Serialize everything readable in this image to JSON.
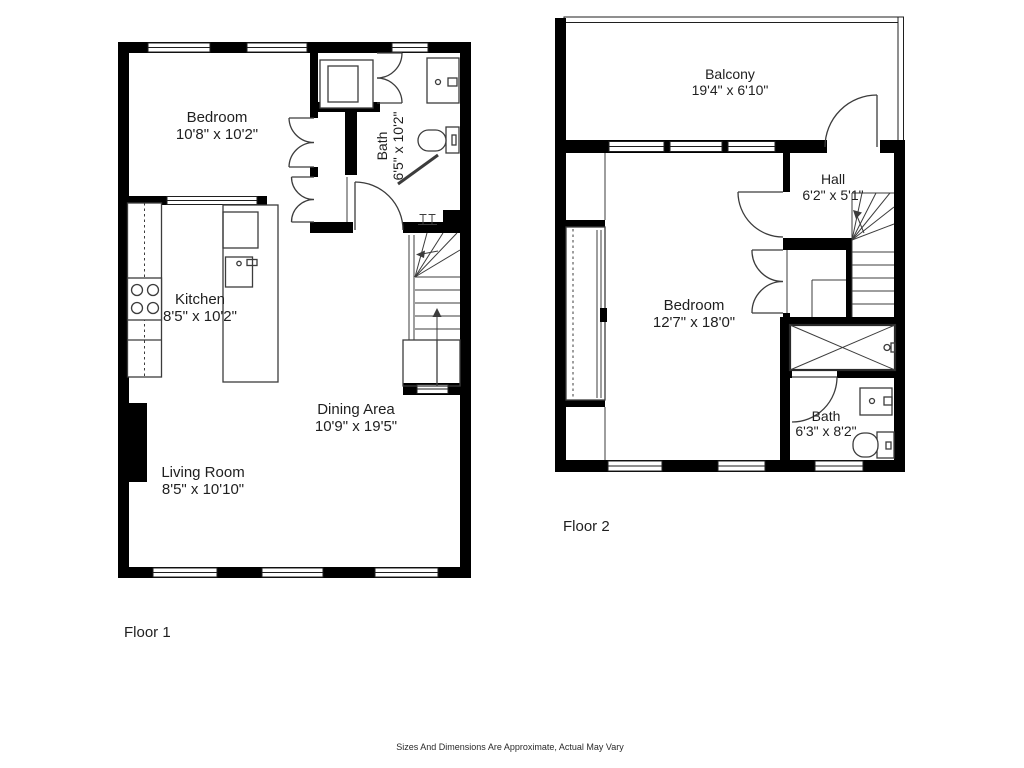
{
  "disclaimer": "Sizes And Dimensions Are Approximate, Actual May Vary",
  "colors": {
    "wall": "#000000",
    "fixture_line": "#3c3c3c",
    "text": "#1f1f1f",
    "background": "#ffffff"
  },
  "floor1": {
    "label": "Floor 1",
    "bedroom": {
      "name": "Bedroom",
      "dims": "10'8\" x 10'2\""
    },
    "bath": {
      "name": "Bath",
      "dims": "6'5\" x 10'2\""
    },
    "kitchen": {
      "name": "Kitchen",
      "dims": "8'5\" x 10'2\""
    },
    "dining": {
      "name": "Dining Area",
      "dims": "10'9\" x 19'5\""
    },
    "living": {
      "name": "Living Room",
      "dims": "8'5\" x 10'10\""
    }
  },
  "floor2": {
    "label": "Floor 2",
    "balcony": {
      "name": "Balcony",
      "dims": "19'4\" x 6'10\""
    },
    "hall": {
      "name": "Hall",
      "dims": "6'2\" x 5'1\""
    },
    "bedroom": {
      "name": "Bedroom",
      "dims": "12'7\" x 18'0\""
    },
    "bath": {
      "name": "Bath",
      "dims": "6'3\" x 8'2\""
    }
  }
}
